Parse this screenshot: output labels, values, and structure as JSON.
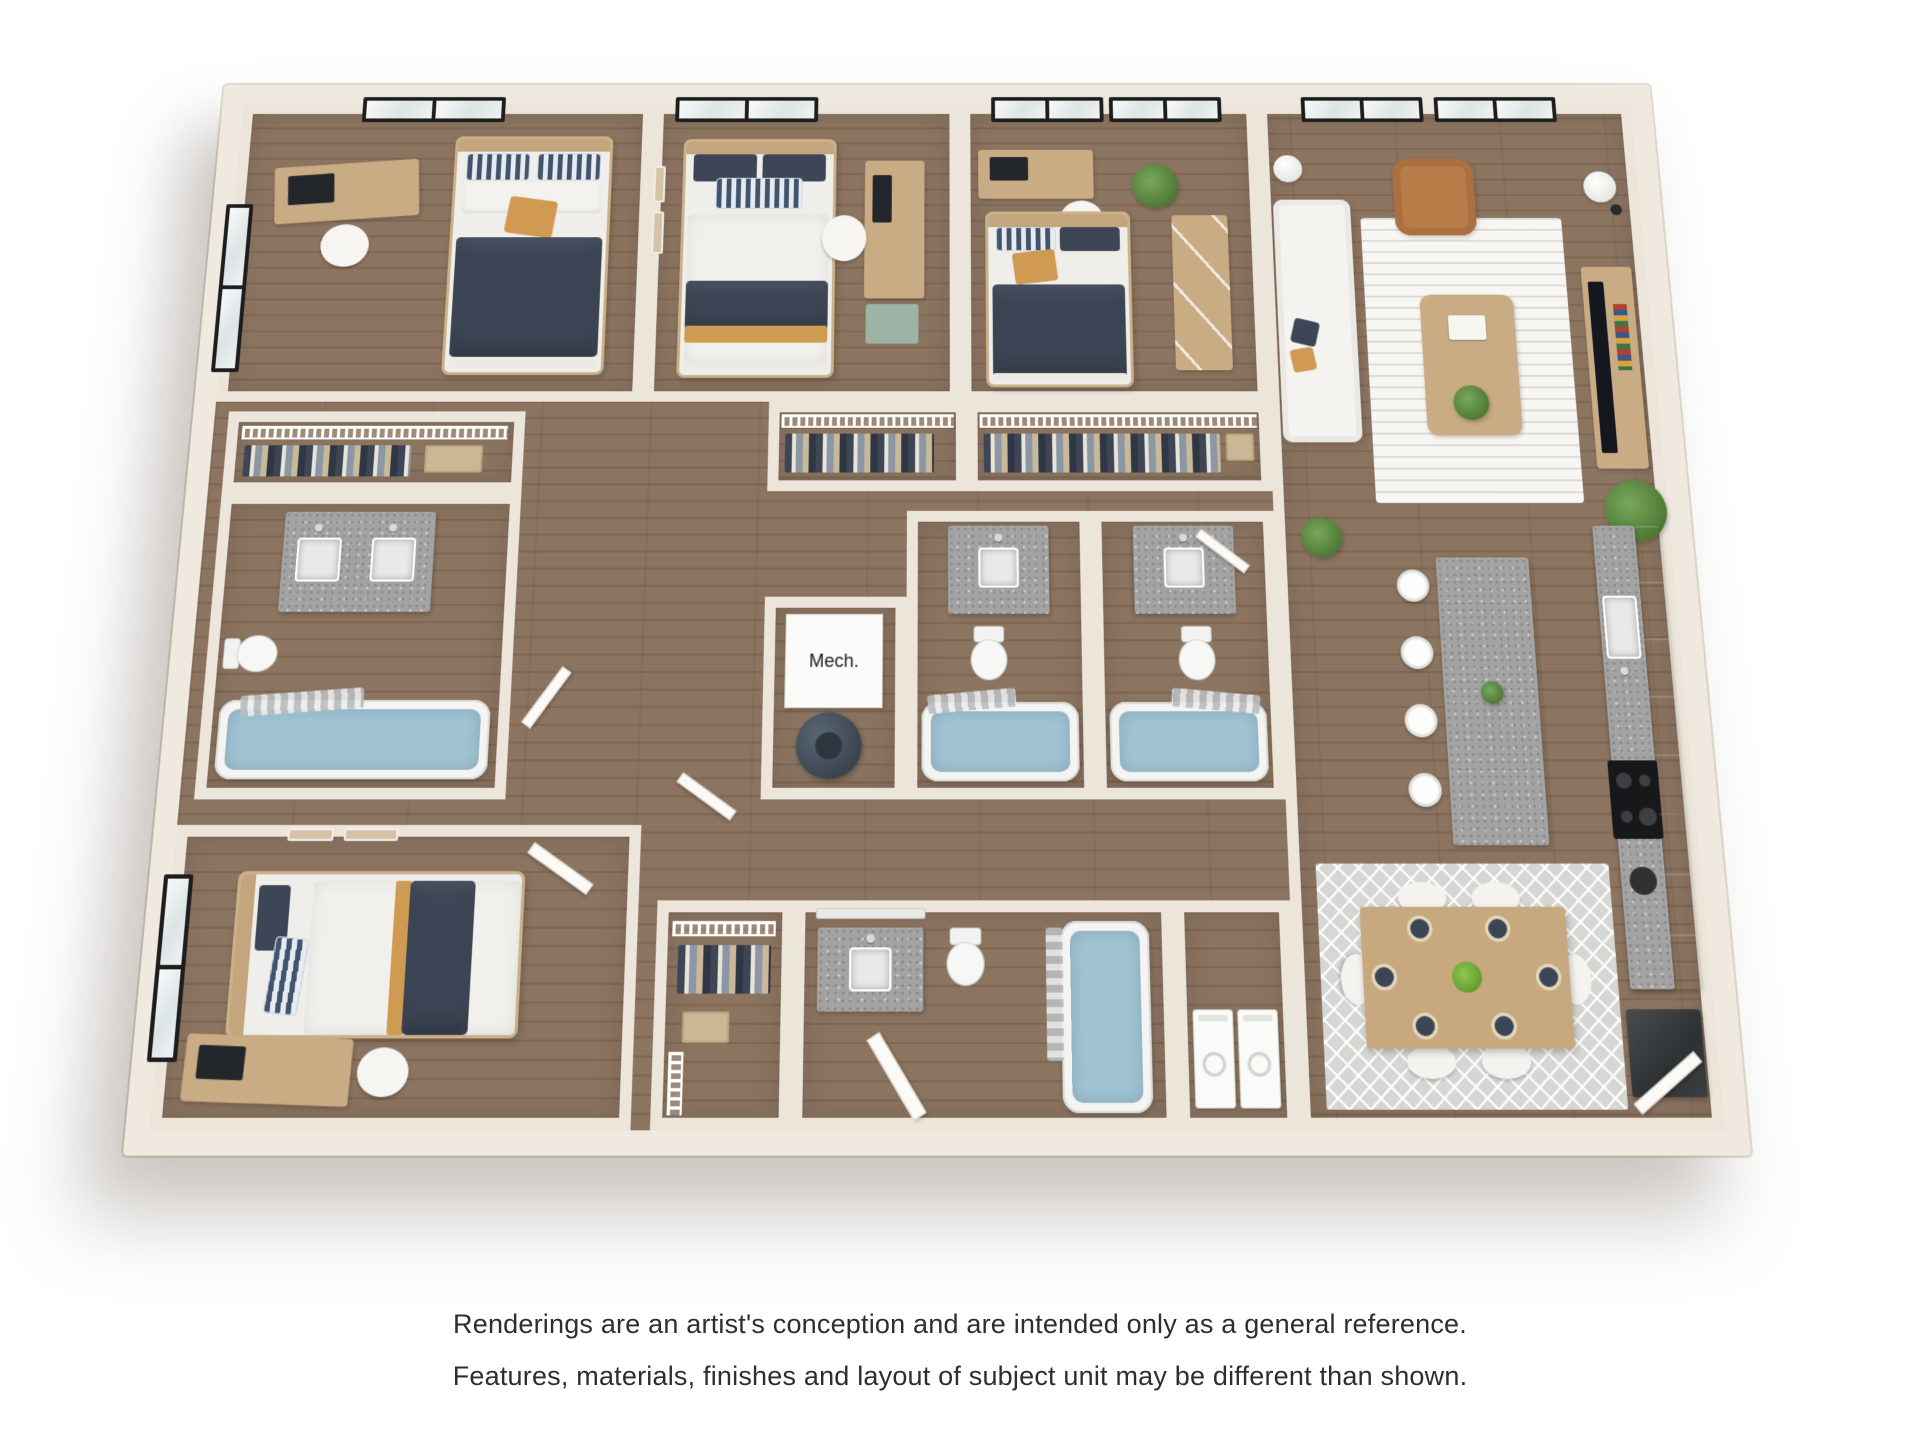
{
  "labels": {
    "mech": "Mech."
  },
  "disclaimer": {
    "line1": "Renderings are an artist's conception and are intended only as a general reference.",
    "line2": "Features, materials, finishes and layout of subject unit may be different than shown."
  },
  "palette": {
    "background": "#ffffff",
    "wall": "#ece5da",
    "wall_outer": "#efe9df",
    "wood_floor": "#8b7460",
    "wood_floor_line": "#7e6753",
    "bedding_navy": "#3d4656",
    "bedding_white": "#f1f0ec",
    "accent_mustard": "#cf9b52",
    "wood_furniture": "#c9ab84",
    "granite": "#a2a3a2",
    "tub_water": "#9fc3d3",
    "leather_chair": "#b87c49",
    "cabinet_gray": "#6f7269",
    "appliance_dark": "#34373a",
    "plant_green": "#5f8f3f",
    "window_frame": "#1d1d1d",
    "rug_light": "#f7f6f2",
    "rug_dining": "#d6d6d2",
    "teal_cabinet": "#9cb3a6"
  },
  "rooms": [
    {
      "id": "bedroom-1",
      "furniture": [
        "bed",
        "desk",
        "desk-chair",
        "window",
        "skylight-window"
      ]
    },
    {
      "id": "bedroom-2",
      "furniture": [
        "bed",
        "desk",
        "desk-chair",
        "file-cabinet",
        "skylight-window",
        "wall-art"
      ]
    },
    {
      "id": "bedroom-3",
      "furniture": [
        "bed",
        "desk",
        "desk-chair",
        "dresser-with-mirror",
        "plant",
        "windows"
      ]
    },
    {
      "id": "bedroom-4",
      "furniture": [
        "bed",
        "desk",
        "desk-chair",
        "window",
        "wall-art",
        "door"
      ]
    },
    {
      "id": "bathroom-1",
      "furniture": [
        "double-vanity",
        "toilet",
        "bathtub",
        "shower-curtain",
        "linen-closet"
      ]
    },
    {
      "id": "bathroom-2",
      "furniture": [
        "vanity",
        "toilet",
        "bathtub",
        "shower-curtain"
      ]
    },
    {
      "id": "bathroom-3",
      "furniture": [
        "vanity",
        "toilet",
        "bathtub",
        "shower-curtain",
        "door"
      ]
    },
    {
      "id": "bathroom-4",
      "furniture": [
        "vanity",
        "mirror",
        "toilet",
        "bathtub",
        "door"
      ]
    },
    {
      "id": "mechanical-room",
      "label": "Mech.",
      "furniture": [
        "water-heater"
      ]
    },
    {
      "id": "laundry-closet",
      "furniture": [
        "washer",
        "dryer"
      ]
    },
    {
      "id": "closet-a",
      "furniture": [
        "wire-shelving",
        "hanging-clothes"
      ]
    },
    {
      "id": "closet-b",
      "furniture": [
        "wire-shelving",
        "hanging-clothes",
        "storage-box"
      ]
    },
    {
      "id": "closet-c",
      "furniture": [
        "wire-shelving",
        "hanging-clothes",
        "basket"
      ]
    },
    {
      "id": "living-room",
      "furniture": [
        "sectional-sofa",
        "accent-chair",
        "coffee-table",
        "area-rug",
        "tv-console",
        "tv",
        "floor-lamp",
        "globe-lamp",
        "potted-palm",
        "windows"
      ]
    },
    {
      "id": "kitchen",
      "furniture": [
        "island",
        "bar-stools",
        "sink",
        "cooktop",
        "coffee-maker",
        "refrigerator",
        "cabinets",
        "island-plant"
      ]
    },
    {
      "id": "dining-area",
      "furniture": [
        "dining-table",
        "six-chairs",
        "six-place-settings",
        "centerpiece",
        "area-rug"
      ]
    },
    {
      "id": "entry",
      "furniture": [
        "door"
      ]
    }
  ]
}
